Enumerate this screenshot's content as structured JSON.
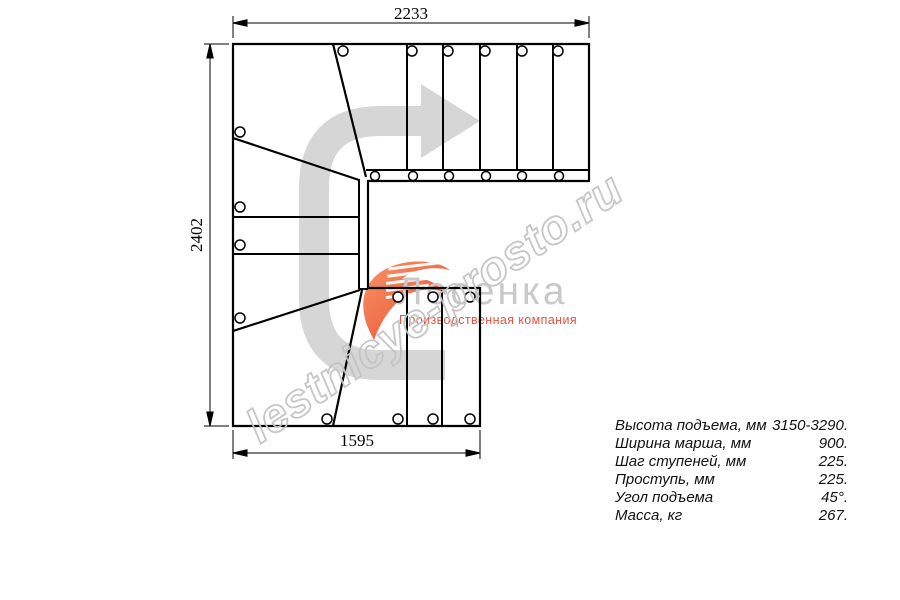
{
  "title": "Stair plan drawing",
  "watermark": {
    "text": "lestnicye-prosto.ru",
    "color": "#c4c4c4"
  },
  "logo": {
    "name": "Лесенка",
    "tagline": "Производственная компания",
    "accent_color": "#ea4326",
    "name_color": "#c9c9c9",
    "icon": "stair-swoosh-icon"
  },
  "dimensions": {
    "top_mm": "2233",
    "left_mm": "2402",
    "bottom_mm": "1595"
  },
  "drawing": {
    "line_color": "#000000",
    "arrow_color": "#d6d6d6",
    "arrow_icon": "direction-arrow-icon",
    "fastener_marks": "screw-circles"
  },
  "specs": {
    "rows": [
      {
        "label": "Высота подъема, мм",
        "value": "3150-3290."
      },
      {
        "label": "Ширина марша, мм",
        "value": "900."
      },
      {
        "label": "Шаг ступеней, мм",
        "value": "225."
      },
      {
        "label": "Проступь, мм",
        "value": "225."
      },
      {
        "label": "Угол подъема",
        "value": "45°."
      },
      {
        "label": "Масса, кг",
        "value": "267."
      }
    ]
  }
}
